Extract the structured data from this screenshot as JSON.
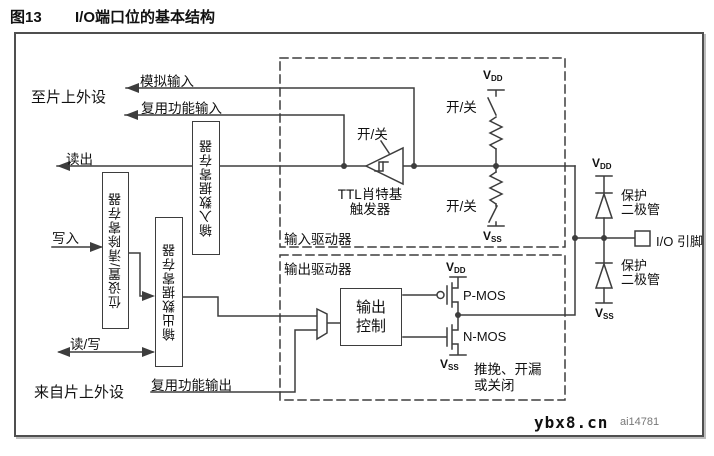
{
  "caption": {
    "number": "图13",
    "title": "I/O端口位的基本结构"
  },
  "left_labels": {
    "to_onchip_peripheral": "至片上外设",
    "analog_input": "模拟输入",
    "alternate_function_input": "复用功能输入",
    "read": "读出",
    "write": "写入",
    "read_write": "读/写",
    "from_onchip_peripheral": "来自片上外设",
    "alternate_function_output": "复用功能输出"
  },
  "registers": {
    "bit_set_clear": "位设置/清除寄存器",
    "output_data": "输出数据寄存器",
    "input_data": "输入数据寄存器"
  },
  "drivers": {
    "input": "输入驱动器",
    "output": "输出驱动器"
  },
  "input_path": {
    "on_off": "开/关",
    "schmitt_trigger_line1": "TTL肖特基",
    "schmitt_trigger_line2": "触发器"
  },
  "output_path": {
    "output_control_line1": "输出",
    "output_control_line2": "控制",
    "pmos": "P-MOS",
    "nmos": "N-MOS",
    "mode_line1": "推挽、开漏",
    "mode_line2": "或关闭"
  },
  "rails": {
    "vdd_base": "V",
    "vdd_sub": "DD",
    "vss_base": "V",
    "vss_sub": "SS"
  },
  "pin": {
    "protection_diode_line1": "保护",
    "protection_diode_line2": "二极管",
    "io_pin": "I/O 引脚"
  },
  "footer": {
    "watermark": "ybx8.cn",
    "figure_id": "ai14781"
  },
  "colors": {
    "line": "#3d3d3d",
    "text": "#111111",
    "frame": "#4f4f4f",
    "figure_id_text": "#777777"
  }
}
